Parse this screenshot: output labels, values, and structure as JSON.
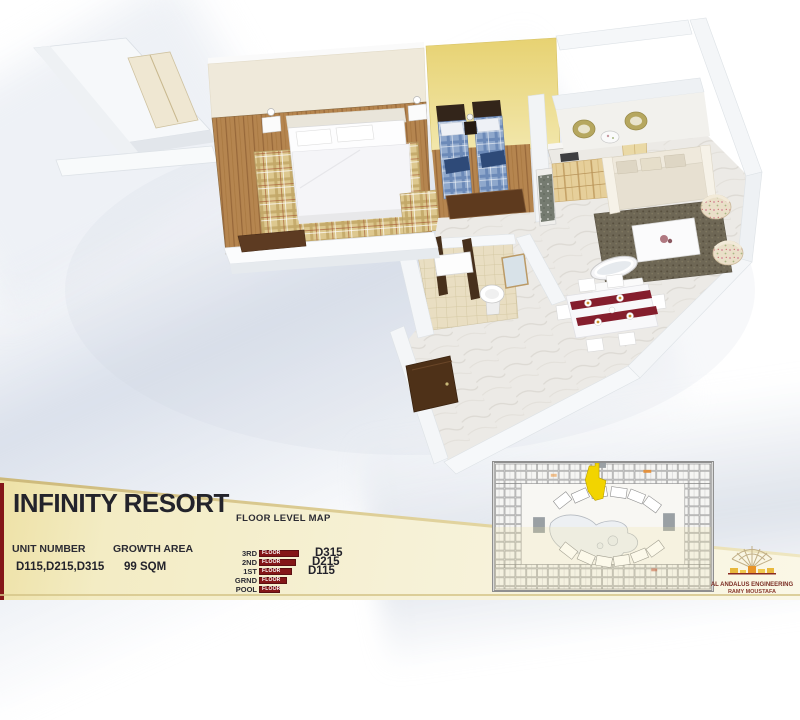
{
  "info_panel": {
    "title": "INFINITY RESORT",
    "floor_level_map_title": "FLOOR LEVEL MAP",
    "unit_number": {
      "label": "UNIT NUMBER",
      "value": "D115,D215,D315"
    },
    "growth_area": {
      "label": "GROWTH AREA",
      "value": "99 SQM"
    },
    "floor_levels": [
      {
        "label": "3RD",
        "bar_label": "FLOOR",
        "bar_width": 40,
        "unit": "D315"
      },
      {
        "label": "2ND",
        "bar_label": "FLOOR",
        "bar_width": 37,
        "unit": "D215"
      },
      {
        "label": "1ST",
        "bar_label": "FLOOR",
        "bar_width": 33,
        "unit": "D115"
      },
      {
        "label": "GRND",
        "bar_label": "FLOOR",
        "bar_width": 28,
        "unit": ""
      },
      {
        "label": "POOL",
        "bar_label": "FLOOR",
        "bar_width": 21,
        "unit": ""
      }
    ]
  },
  "logo": {
    "company": "AL ANDALUS ENGINEERING",
    "person": "RAMY MOUSTAFA",
    "icon": "dome-arches-icon"
  },
  "site_map": {
    "icon": "resort-site-plan-icon",
    "highlight_color": "#f2d400"
  },
  "colors": {
    "accent_maroon": "#841618",
    "panel_cream": "#f4eecb",
    "bedroom_wall_yellow": "#e9d77e",
    "wood_floor": "#b5854f"
  }
}
